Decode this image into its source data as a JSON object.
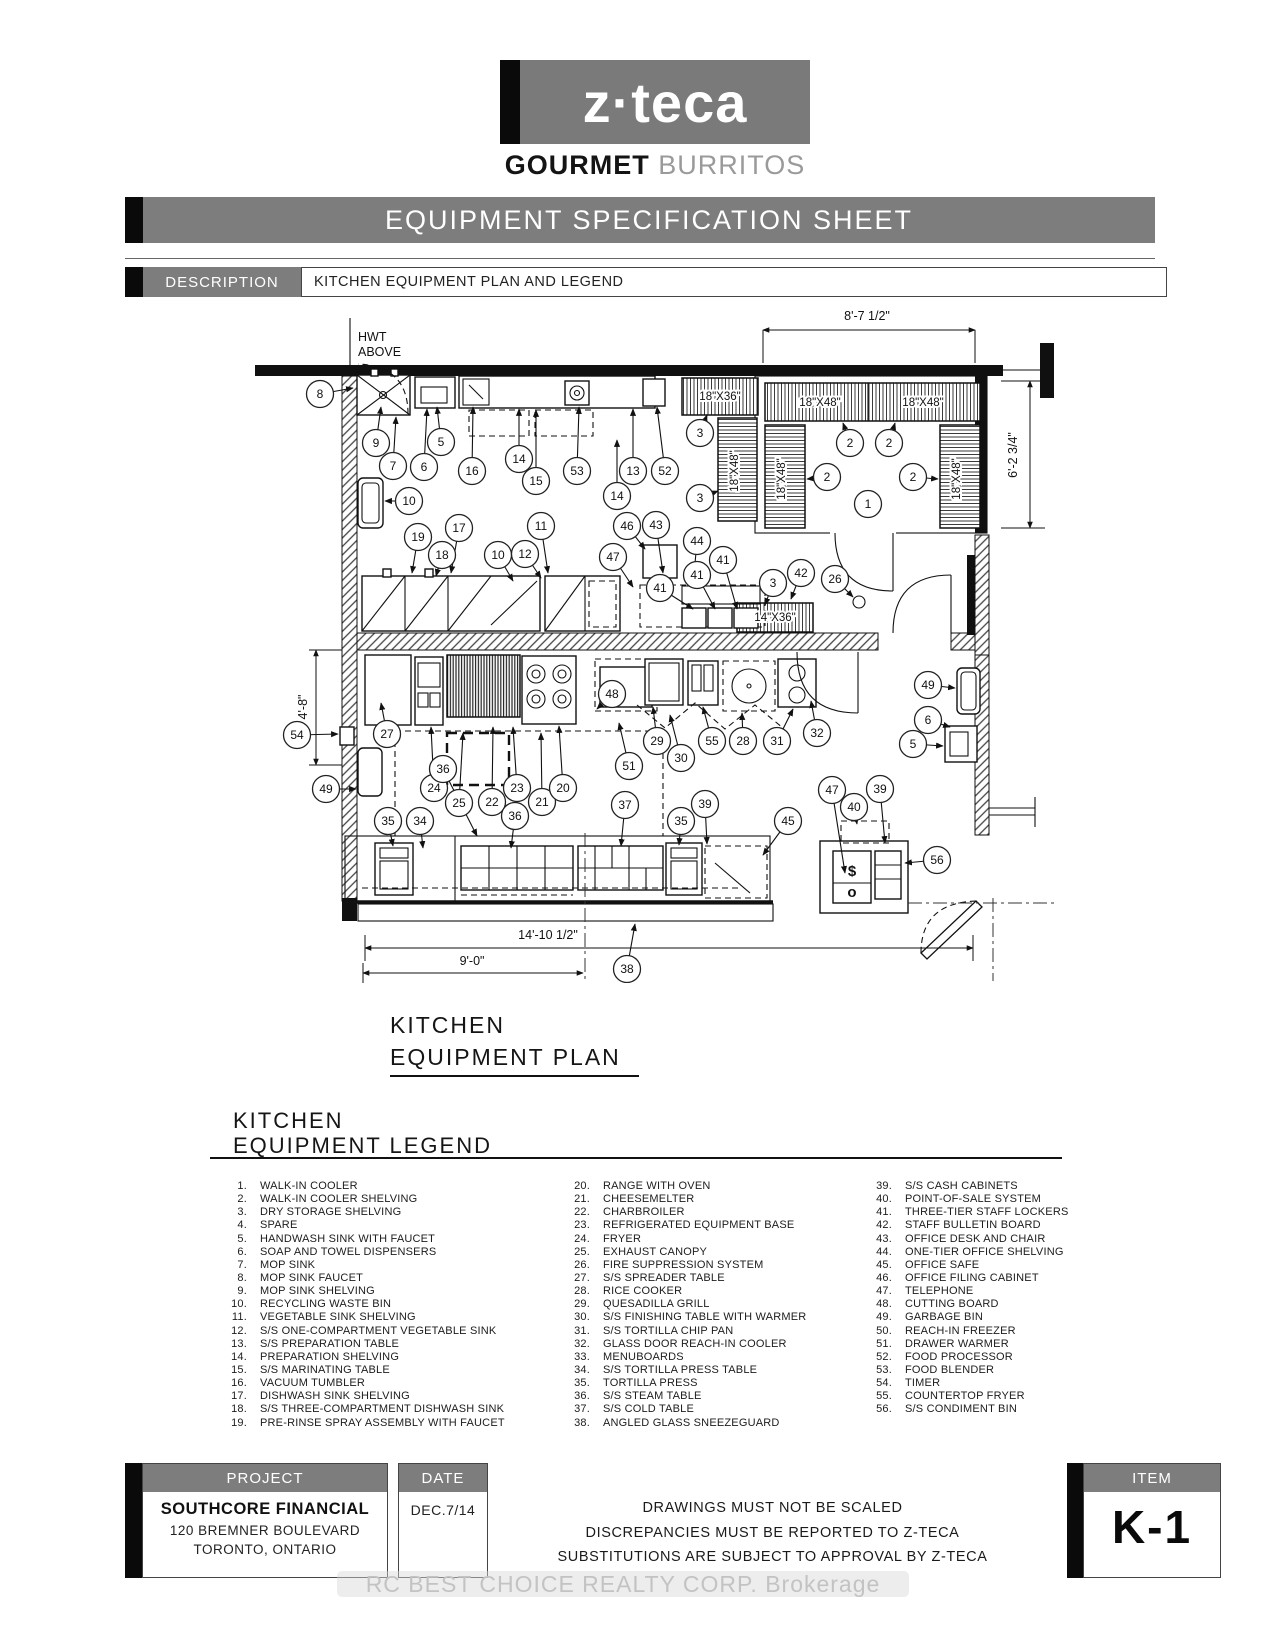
{
  "brand": {
    "logo": "z·teca",
    "tag_bold": "GOURMET",
    "tag_light": "BURRITOS"
  },
  "banner": "EQUIPMENT SPECIFICATION SHEET",
  "description": {
    "label": "DESCRIPTION",
    "value": "KITCHEN EQUIPMENT PLAN AND LEGEND"
  },
  "plan": {
    "title1": "KITCHEN",
    "title2": "EQUIPMENT PLAN",
    "notes": [
      {
        "t": "HWT",
        "x": 113,
        "y": 38
      },
      {
        "t": "ABOVE",
        "x": 113,
        "y": 53
      }
    ],
    "dims": [
      {
        "t": "8'-7 1/2\"",
        "x": 622,
        "y": 17
      },
      {
        "t": "6'-2 3/4\"",
        "x": 772,
        "y": 152,
        "r": -90
      },
      {
        "t": "4'-8\"",
        "x": 62,
        "y": 404,
        "r": -90
      },
      {
        "t": "14'-10 1/2\"",
        "x": 303,
        "y": 636
      },
      {
        "t": "9'-0\"",
        "x": 227,
        "y": 662
      }
    ],
    "shelf_labels": [
      {
        "t": "18\"X36\"",
        "x": 475,
        "y": 97
      },
      {
        "t": "18\"X48\"",
        "x": 575,
        "y": 103
      },
      {
        "t": "18\"X48\"",
        "x": 678,
        "y": 103
      },
      {
        "t": "18\"X48\"",
        "x": 540,
        "y": 176,
        "r": -90
      },
      {
        "t": "18\"X48\"",
        "x": 715,
        "y": 176,
        "r": -90
      },
      {
        "t": "18\"X48\"",
        "x": 493,
        "y": 168,
        "r": -90
      },
      {
        "t": "14\"X36\"",
        "x": 530,
        "y": 318
      }
    ],
    "glyphs": [
      {
        "t": "$",
        "x": 607,
        "y": 573
      },
      {
        "t": "o",
        "x": 607,
        "y": 594
      }
    ],
    "callouts": [
      {
        "n": "8",
        "x": 75,
        "y": 91,
        "ax": 108,
        "ay": 85
      },
      {
        "n": "9",
        "x": 131,
        "y": 140,
        "ax": 136,
        "ay": 104
      },
      {
        "n": "7",
        "x": 148,
        "y": 163,
        "ax": 151,
        "ay": 114
      },
      {
        "n": "6",
        "x": 179,
        "y": 164,
        "ax": 182,
        "ay": 106
      },
      {
        "n": "5",
        "x": 196,
        "y": 139,
        "ax": 192,
        "ay": 104
      },
      {
        "n": "16",
        "x": 227,
        "y": 168,
        "ax": 228,
        "ay": 104
      },
      {
        "n": "14",
        "x": 274,
        "y": 156,
        "ax": 274,
        "ay": 106
      },
      {
        "n": "15",
        "x": 291,
        "y": 178,
        "ax": 291,
        "ay": 107
      },
      {
        "n": "53",
        "x": 332,
        "y": 168,
        "ax": 334,
        "ay": 104
      },
      {
        "n": "13",
        "x": 388,
        "y": 168,
        "ax": 388,
        "ay": 106
      },
      {
        "n": "52",
        "x": 420,
        "y": 168,
        "ax": 412,
        "ay": 104
      },
      {
        "n": "14",
        "x": 372,
        "y": 193,
        "ax": 372,
        "ay": 137
      },
      {
        "n": "10",
        "x": 164,
        "y": 198,
        "ax": 140,
        "ay": 198
      },
      {
        "n": "3",
        "x": 455,
        "y": 130,
        "ax": 462,
        "ay": 112
      },
      {
        "n": "3",
        "x": 455,
        "y": 195,
        "ax": 473,
        "ay": 188
      },
      {
        "n": "2",
        "x": 605,
        "y": 140,
        "ax": 598,
        "ay": 120
      },
      {
        "n": "2",
        "x": 644,
        "y": 140,
        "ax": 650,
        "ay": 120
      },
      {
        "n": "2",
        "x": 582,
        "y": 174,
        "ax": 562,
        "ay": 176
      },
      {
        "n": "2",
        "x": 668,
        "y": 174,
        "ax": 693,
        "ay": 176
      },
      {
        "n": "1",
        "x": 623,
        "y": 201
      },
      {
        "n": "3",
        "x": 528,
        "y": 280,
        "ax": 520,
        "ay": 302
      },
      {
        "n": "42",
        "x": 556,
        "y": 270,
        "ax": 546,
        "ay": 296
      },
      {
        "n": "26",
        "x": 590,
        "y": 276,
        "ax": 608,
        "ay": 294
      },
      {
        "n": "19",
        "x": 173,
        "y": 234,
        "ax": 167,
        "ay": 270
      },
      {
        "n": "18",
        "x": 197,
        "y": 252,
        "ax": 191,
        "ay": 273
      },
      {
        "n": "17",
        "x": 214,
        "y": 225,
        "ax": 206,
        "ay": 270
      },
      {
        "n": "10",
        "x": 253,
        "y": 252,
        "ax": 268,
        "ay": 278
      },
      {
        "n": "12",
        "x": 280,
        "y": 251,
        "ax": 296,
        "ay": 275
      },
      {
        "n": "11",
        "x": 296,
        "y": 223,
        "ax": 303,
        "ay": 270
      },
      {
        "n": "46",
        "x": 382,
        "y": 223,
        "ax": 400,
        "ay": 246
      },
      {
        "n": "43",
        "x": 411,
        "y": 222,
        "ax": 418,
        "ay": 270
      },
      {
        "n": "47",
        "x": 368,
        "y": 254,
        "ax": 388,
        "ay": 284
      },
      {
        "n": "44",
        "x": 452,
        "y": 238,
        "ax": 448,
        "ay": 283
      },
      {
        "n": "41",
        "x": 415,
        "y": 285,
        "ax": 448,
        "ay": 306
      },
      {
        "n": "41",
        "x": 452,
        "y": 272,
        "ax": 470,
        "ay": 306
      },
      {
        "n": "41",
        "x": 478,
        "y": 257,
        "ax": 492,
        "ay": 306
      },
      {
        "n": "54",
        "x": 52,
        "y": 432,
        "ax": 93,
        "ay": 431
      },
      {
        "n": "27",
        "x": 142,
        "y": 431,
        "ax": 136,
        "ay": 400
      },
      {
        "n": "49",
        "x": 81,
        "y": 486,
        "ax": 111,
        "ay": 486
      },
      {
        "n": "24",
        "x": 189,
        "y": 485,
        "ax": 186,
        "ay": 424
      },
      {
        "n": "25",
        "x": 214,
        "y": 500,
        "ax": 218,
        "ay": 430
      },
      {
        "n": "22",
        "x": 247,
        "y": 499,
        "ax": 248,
        "ay": 424
      },
      {
        "n": "36",
        "x": 198,
        "y": 466,
        "ax": 232,
        "ay": 533
      },
      {
        "n": "23",
        "x": 272,
        "y": 485,
        "ax": 268,
        "ay": 424
      },
      {
        "n": "21",
        "x": 297,
        "y": 499,
        "ax": 296,
        "ay": 430
      },
      {
        "n": "20",
        "x": 318,
        "y": 485,
        "ax": 314,
        "ay": 423
      },
      {
        "n": "48",
        "x": 367,
        "y": 391,
        "ax": 352,
        "ay": 406
      },
      {
        "n": "29",
        "x": 412,
        "y": 438,
        "ax": 408,
        "ay": 404
      },
      {
        "n": "30",
        "x": 436,
        "y": 455,
        "ax": 425,
        "ay": 412
      },
      {
        "n": "55",
        "x": 467,
        "y": 438,
        "ax": 458,
        "ay": 404
      },
      {
        "n": "28",
        "x": 498,
        "y": 438,
        "ax": 497,
        "ay": 410
      },
      {
        "n": "31",
        "x": 532,
        "y": 438,
        "ax": 548,
        "ay": 406
      },
      {
        "n": "32",
        "x": 572,
        "y": 430,
        "ax": 566,
        "ay": 398
      },
      {
        "n": "51",
        "x": 384,
        "y": 463,
        "ax": 374,
        "ay": 420
      },
      {
        "n": "37",
        "x": 380,
        "y": 502,
        "ax": 376,
        "ay": 543
      },
      {
        "n": "39",
        "x": 460,
        "y": 501,
        "ax": 462,
        "ay": 541
      },
      {
        "n": "35",
        "x": 436,
        "y": 518,
        "ax": 434,
        "ay": 542
      },
      {
        "n": "45",
        "x": 543,
        "y": 518,
        "ax": 518,
        "ay": 552
      },
      {
        "n": "47",
        "x": 587,
        "y": 487,
        "ax": 600,
        "ay": 570
      },
      {
        "n": "40",
        "x": 609,
        "y": 504,
        "ax": 612,
        "ay": 521
      },
      {
        "n": "39",
        "x": 635,
        "y": 486,
        "ax": 640,
        "ay": 540
      },
      {
        "n": "56",
        "x": 692,
        "y": 557,
        "ax": 660,
        "ay": 560
      },
      {
        "n": "49",
        "x": 683,
        "y": 382,
        "ax": 710,
        "ay": 385
      },
      {
        "n": "6",
        "x": 683,
        "y": 417,
        "ax": 705,
        "ay": 424
      },
      {
        "n": "5",
        "x": 668,
        "y": 441,
        "ax": 698,
        "ay": 443
      },
      {
        "n": "35",
        "x": 143,
        "y": 518,
        "ax": 148,
        "ay": 543
      },
      {
        "n": "34",
        "x": 175,
        "y": 518,
        "ax": 178,
        "ay": 545
      },
      {
        "n": "36",
        "x": 270,
        "y": 513,
        "ax": 266,
        "ay": 545
      },
      {
        "n": "38",
        "x": 382,
        "y": 666,
        "ax": 390,
        "ay": 621
      }
    ]
  },
  "legend": {
    "title1": "KITCHEN",
    "title2": "EQUIPMENT LEGEND",
    "columns": [
      [
        {
          "n": "1.",
          "t": "WALK-IN COOLER"
        },
        {
          "n": "2.",
          "t": "WALK-IN COOLER SHELVING"
        },
        {
          "n": "3.",
          "t": "DRY STORAGE SHELVING"
        },
        {
          "n": "4.",
          "t": "SPARE"
        },
        {
          "n": "5.",
          "t": "HANDWASH SINK WITH FAUCET"
        },
        {
          "n": "6.",
          "t": "SOAP AND TOWEL DISPENSERS"
        },
        {
          "n": "7.",
          "t": "MOP SINK"
        },
        {
          "n": "8.",
          "t": "MOP SINK FAUCET"
        },
        {
          "n": "9.",
          "t": "MOP SINK SHELVING"
        },
        {
          "n": "10.",
          "t": "RECYCLING WASTE BIN"
        },
        {
          "n": "11.",
          "t": "VEGETABLE SINK SHELVING"
        },
        {
          "n": "12.",
          "t": "S/S ONE-COMPARTMENT VEGETABLE SINK"
        },
        {
          "n": "13.",
          "t": "S/S PREPARATION TABLE"
        },
        {
          "n": "14.",
          "t": "PREPARATION SHELVING"
        },
        {
          "n": "15.",
          "t": "S/S MARINATING TABLE"
        },
        {
          "n": "16.",
          "t": "VACUUM TUMBLER"
        },
        {
          "n": "17.",
          "t": "DISHWASH SINK SHELVING"
        },
        {
          "n": "18.",
          "t": "S/S THREE-COMPARTMENT DISHWASH SINK"
        },
        {
          "n": "19.",
          "t": "PRE-RINSE SPRAY ASSEMBLY WITH FAUCET"
        }
      ],
      [
        {
          "n": "20.",
          "t": "RANGE WITH OVEN"
        },
        {
          "n": "21.",
          "t": "CHEESEMELTER"
        },
        {
          "n": "22.",
          "t": "CHARBROILER"
        },
        {
          "n": "23.",
          "t": "REFRIGERATED EQUIPMENT BASE"
        },
        {
          "n": "24.",
          "t": "FRYER"
        },
        {
          "n": "25.",
          "t": "EXHAUST CANOPY"
        },
        {
          "n": "26.",
          "t": "FIRE SUPPRESSION SYSTEM"
        },
        {
          "n": "27.",
          "t": "S/S SPREADER TABLE"
        },
        {
          "n": "28.",
          "t": "RICE COOKER"
        },
        {
          "n": "29.",
          "t": "QUESADILLA GRILL"
        },
        {
          "n": "30.",
          "t": "S/S FINISHING TABLE WITH WARMER"
        },
        {
          "n": "31.",
          "t": "S/S TORTILLA CHIP PAN"
        },
        {
          "n": "32.",
          "t": "GLASS DOOR REACH-IN COOLER"
        },
        {
          "n": "33.",
          "t": "MENUBOARDS"
        },
        {
          "n": "34.",
          "t": "S/S TORTILLA PRESS TABLE"
        },
        {
          "n": "35.",
          "t": "TORTILLA PRESS"
        },
        {
          "n": "36.",
          "t": "S/S STEAM TABLE"
        },
        {
          "n": "37.",
          "t": "S/S COLD TABLE"
        },
        {
          "n": "38.",
          "t": "ANGLED GLASS SNEEZEGUARD"
        }
      ],
      [
        {
          "n": "39.",
          "t": "S/S CASH CABINETS"
        },
        {
          "n": "40.",
          "t": "POINT-OF-SALE SYSTEM"
        },
        {
          "n": "41.",
          "t": "THREE-TIER STAFF LOCKERS"
        },
        {
          "n": "42.",
          "t": "STAFF BULLETIN BOARD"
        },
        {
          "n": "43.",
          "t": "OFFICE DESK AND CHAIR"
        },
        {
          "n": "44.",
          "t": "ONE-TIER OFFICE SHELVING"
        },
        {
          "n": "45.",
          "t": "OFFICE SAFE"
        },
        {
          "n": "46.",
          "t": "OFFICE FILING CABINET"
        },
        {
          "n": "47.",
          "t": "TELEPHONE"
        },
        {
          "n": "48.",
          "t": "CUTTING BOARD"
        },
        {
          "n": "49.",
          "t": "GARBAGE BIN"
        },
        {
          "n": "50.",
          "t": "REACH-IN FREEZER"
        },
        {
          "n": "51.",
          "t": "DRAWER WARMER"
        },
        {
          "n": "52.",
          "t": "FOOD PROCESSOR"
        },
        {
          "n": "53.",
          "t": "FOOD BLENDER"
        },
        {
          "n": "54.",
          "t": "TIMER"
        },
        {
          "n": "55.",
          "t": "COUNTERTOP FRYER"
        },
        {
          "n": "56.",
          "t": "S/S CONDIMENT BIN"
        }
      ]
    ]
  },
  "footer": {
    "project": {
      "label": "PROJECT",
      "name": "SOUTHCORE FINANCIAL",
      "address1": "120 BREMNER BOULEVARD",
      "address2": "TORONTO, ONTARIO"
    },
    "date": {
      "label": "DATE",
      "value": "DEC.7/14"
    },
    "notes": [
      "DRAWINGS MUST NOT BE SCALED",
      "DISCREPANCIES MUST BE REPORTED TO Z-TECA",
      "SUBSTITUTIONS ARE SUBJECT TO APPROVAL BY Z-TECA"
    ],
    "item": {
      "label": "ITEM",
      "value": "K-1"
    }
  },
  "watermark": "RC BEST CHOICE REALTY CORP. Brokerage"
}
